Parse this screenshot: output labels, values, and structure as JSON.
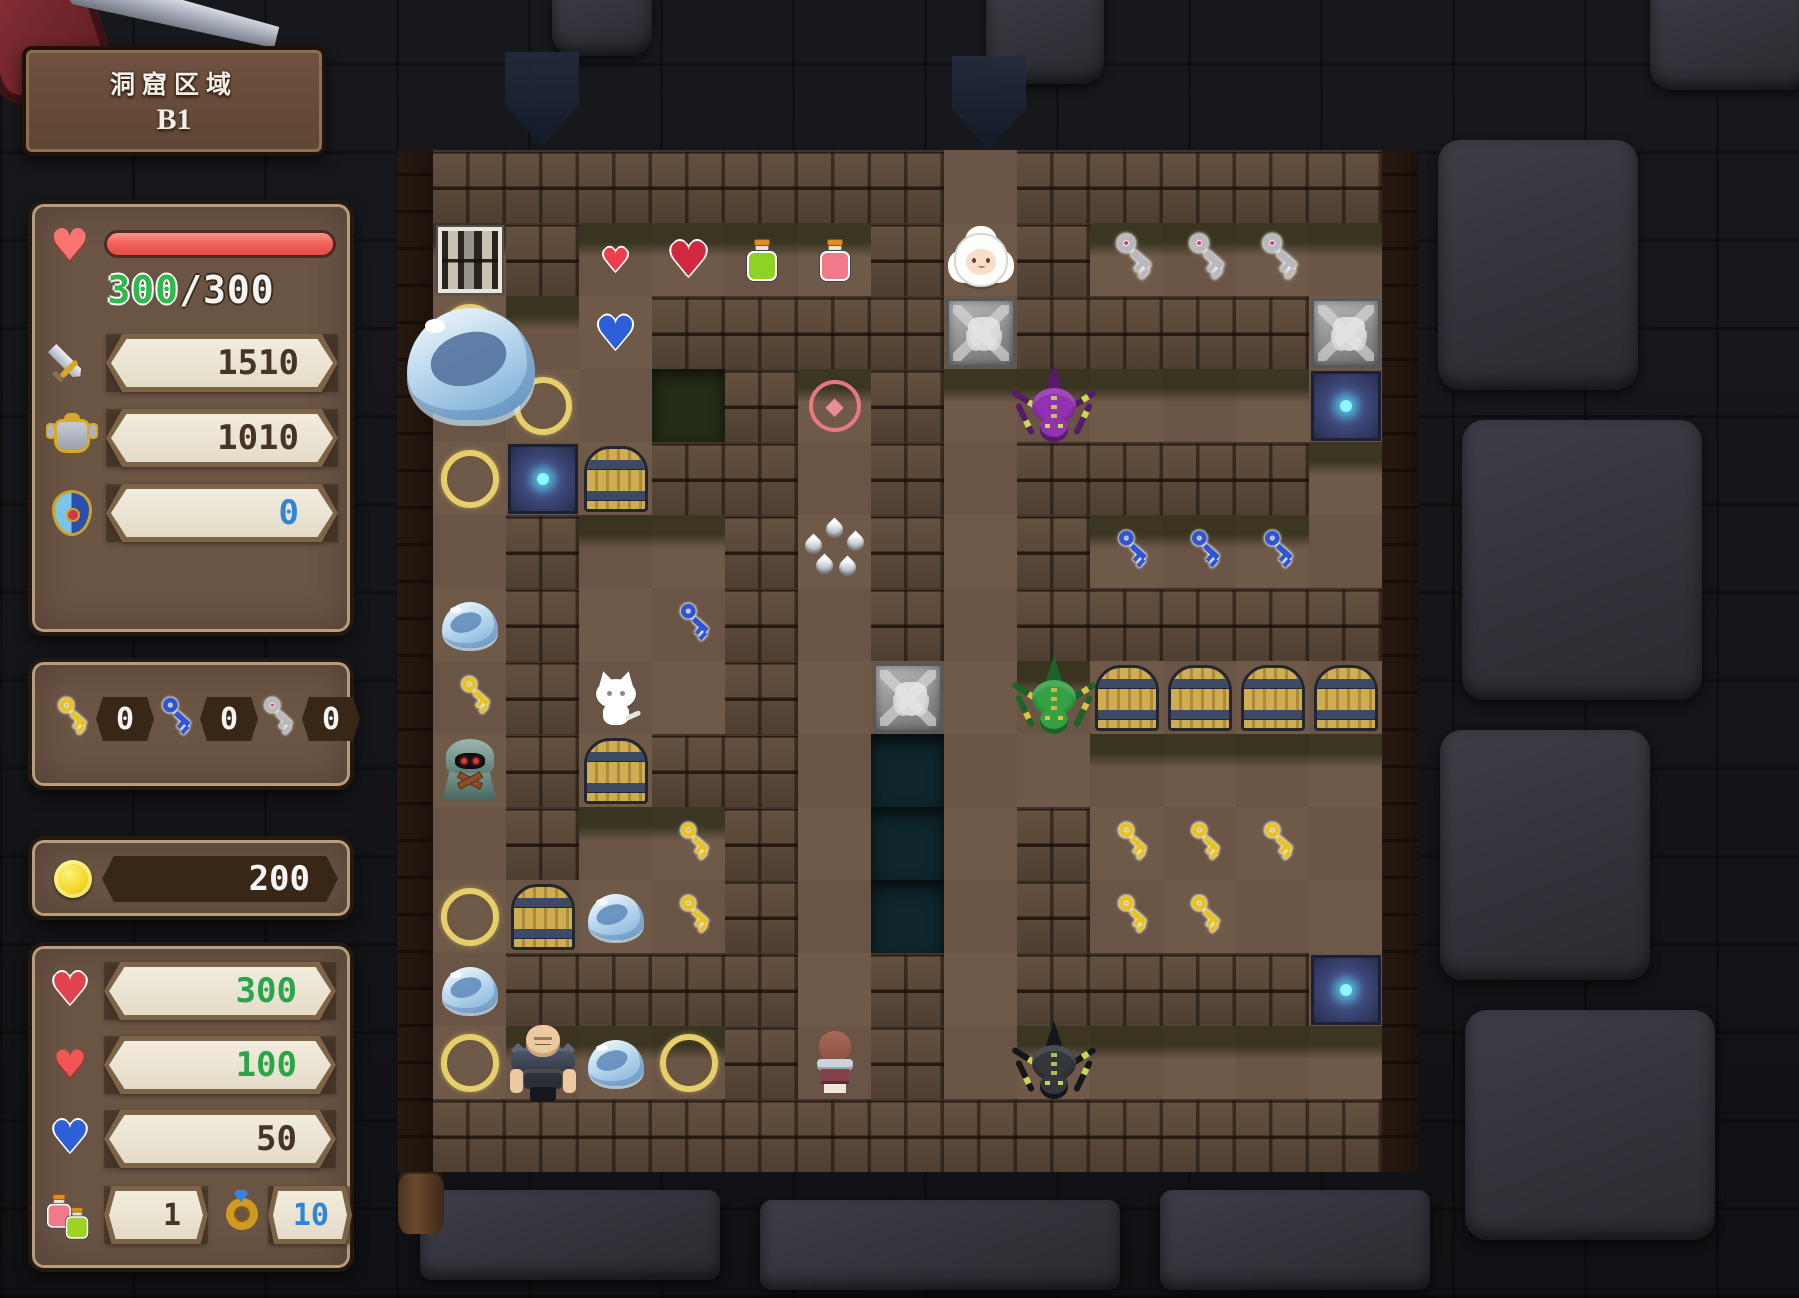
{
  "banner": {
    "title": "洞窟区域",
    "floor": "B1"
  },
  "stats": {
    "hp_current": "300",
    "hp_rest": "/300",
    "hp_percent": 100,
    "attack": "1510",
    "defense": "1010",
    "magic_defense": "0"
  },
  "keys": {
    "yellow": "0",
    "blue": "0",
    "gray": "0"
  },
  "gold": "200",
  "items": {
    "red_gem": "300",
    "heart": "100",
    "blue_gem": "50",
    "potion": "1",
    "ring": "10"
  },
  "colors": {
    "hp_bar": "#f2625c",
    "green_number": "#2aa64a",
    "blue_number": "#2e86d6",
    "panel": "#6a5444",
    "gold_coin": "#f3d525",
    "ring_circle": "#e6cf6a"
  },
  "map": {
    "tile_size": 73,
    "cols": 13,
    "rows": 14,
    "grid": [
      "#######.#####",
      "B#hqgp#S#KKK.",
      "o.b####E####E",
      ".o.v#R#.P...m",
      "omw##.#.####.",
      ".#..#d#.#kkk.",
      "s#.k#.#.#####",
      "Y#C.#.E.Gwwww",
      "Z#w##.t......",
      ".#.Y#.t.#YYY.",
      "owsY#.t.#YY..",
      "s####.#.####m",
      "oDso#H#.X....",
      "#############"
    ],
    "legend": {
      "#": "wall",
      ".": "floor",
      "v": "dark-void",
      "t": "pit",
      "B": "bookshelf",
      "h": "small-red-heart",
      "q": "large-red-heart",
      "g": "green-potion",
      "p": "red-potion",
      "b": "blue-heart-gem",
      "S": "sheep",
      "K": "gray-key",
      "k": "blue-key",
      "Y": "yellow-key",
      "o": "gold-ring-circle",
      "E": "stone-emblem",
      "m": "magic-door",
      "w": "wooden-door",
      "R": "red-gem-circle",
      "d": "metal-drops",
      "s": "slime",
      "P": "purple-spider",
      "G": "green-spider",
      "X": "black-spider",
      "C": "white-cat",
      "Z": "hooded-monster",
      "D": "dwarf-warrior",
      "H": "hero"
    },
    "big_slime": {
      "left": 10,
      "top": 158,
      "width": 128,
      "height": 112
    }
  }
}
